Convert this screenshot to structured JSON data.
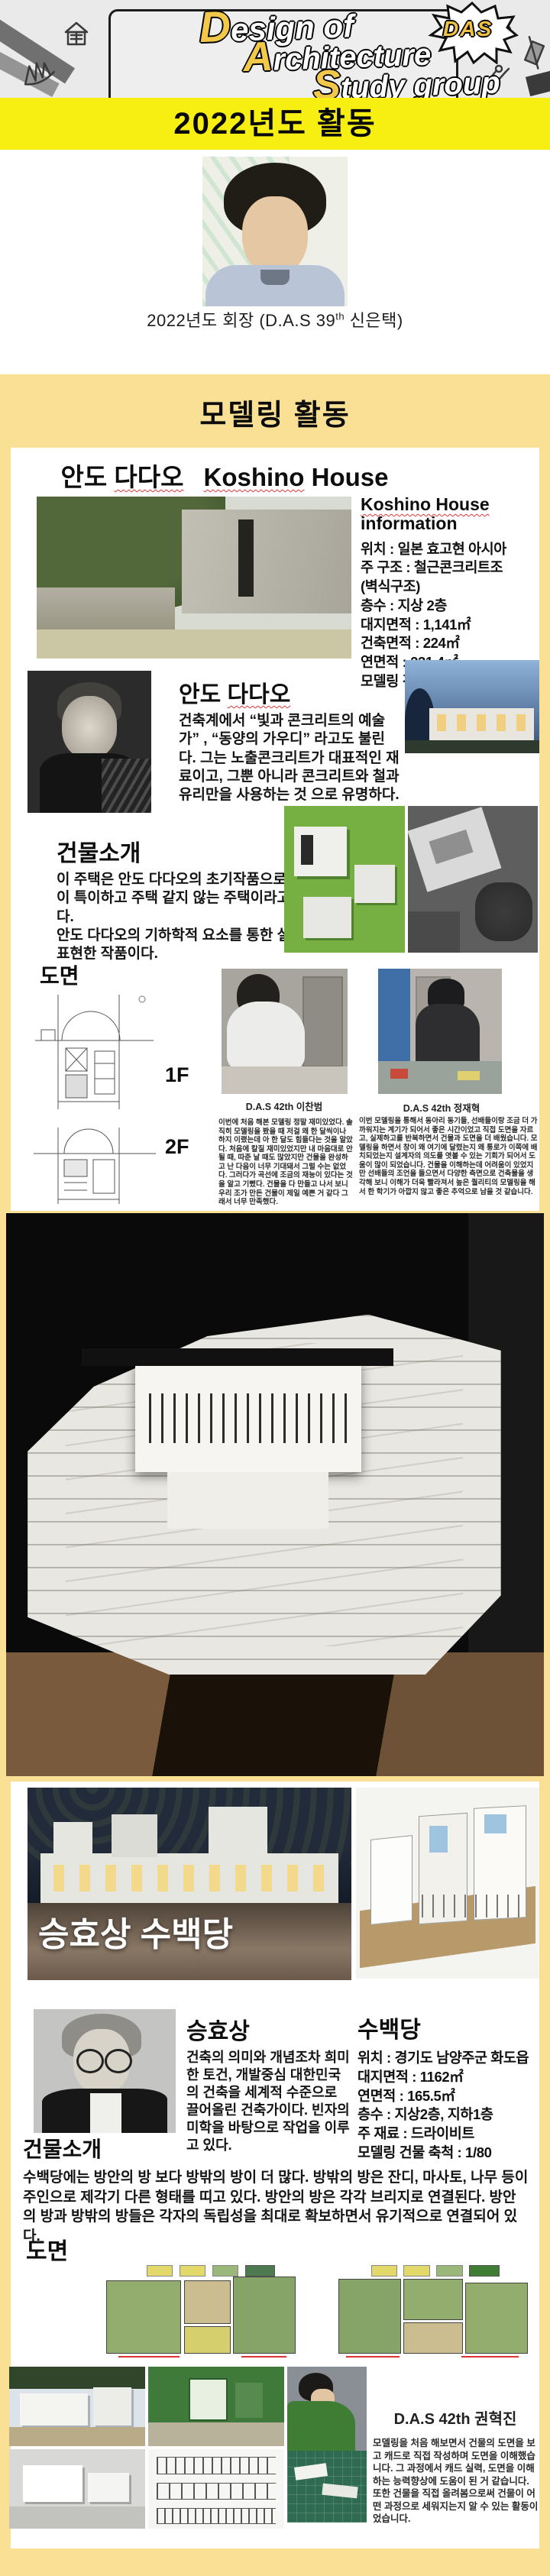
{
  "header": {
    "logo": {
      "l1_cap": "D",
      "l1_rest": "esign of",
      "l2_cap": "A",
      "l2_rest": "rchitecture",
      "l3_cap": "S",
      "l3_rest": "tudy group"
    },
    "badge": "DAS"
  },
  "banners": {
    "year": "2022년도 활동",
    "modeling": "모델링 활동"
  },
  "president": {
    "caption_pre": "2022년도 회장 (D.A.S 39",
    "caption_sup": "th",
    "caption_post": " 신은택)"
  },
  "koshino": {
    "title": {
      "kr1": "안도 ",
      "kr2": "다다오",
      "en1": "Koshino",
      "en2": " House"
    },
    "info": {
      "heading1": "Koshino House",
      "heading2": "information",
      "lines": [
        "위치 : 일본 효고현 아시아",
        "주 구조 : 철근콘크리트조",
        "(벽식구조)",
        "층수 : 지상 2층",
        "대지면적 : 1,141㎡",
        "건축면적 : 224㎡",
        "연면적 : 231.4㎡",
        "모델링 건물 축척 :1/75"
      ]
    },
    "architect": {
      "heading1": "안도 ",
      "heading2": "다다오",
      "body": "건축계에서 “빛과 콘크리트의 예술가” , “동양의 가우디” 라고도 불린다. 그는 노출콘크리트가 대표적인 재료이고, 그뿐 아니라 콘크리트와 철과 유리만을 사용하는 것 으로 유명하다."
    },
    "intro": {
      "heading": "건물소개",
      "body": "이 주택은 안도 다다오의 초기작품으로 공간구성이 특이하고 주택 같지 않는 주택이라고 느껴진다.\n안도 다다오의 기하학적 요소를 통한 설계를 잘 표현한 작품이다."
    },
    "plans": {
      "heading": "도면",
      "floor1": "1F",
      "floor2": "2F"
    },
    "members": [
      {
        "caption": "D.A.S 42th 이찬범",
        "body": "이번에 처음 해본 모델링 정말 재미있었다. 솔직히 모델링을 봤을 때 저걸 왜 한 달씩이나 하지 이랬는데 아 한 달도 힘들다는 것을 알았다. 처음에 칼질 재미있었지만 내 마음대로 안될 때, 따준 날 때도 많았지만 건물을 완성하고 난 다음이 너무 기대돼서 그럴 수는 없었다. 그러다가 곡선에 조금의 재능이 있다는 것을 알고 기뻤다. 건물을 다 만들고 나서 보니 우리 조가 만든 건물이 제일 예쁜 거 같다 그래서 너무 만족했다."
      },
      {
        "caption": "D.A.S 42th 정재혁",
        "body": "이번 모델링을 통해서 동아리 동기들, 선배들이랑 조금 더 가까워지는 계기가 되어서 좋은 시간이었고 직접 도면을 자르고, 실제하고를 반복하면서 건물과 도면을 더 배웠습니다. 모델링을 하면서 창이 왜 여기에 달렸는지 왜 통로가 이쪽에 배치되었는지 설계자의 의도를 엿볼 수 있는 기회가 되어서 도움이 많이 되었습니다. 건물을 이해하는데 어려움이 있었지만 선배들의 조언을 들으면서 다양한 측면으로 건축물을 생각해 보니 이해가 더욱 빨라져서 높은 퀄리티의 모델링을 해서 한 학기가 아깝지 않고 좋은 추억으로 남을 것 같습니다."
      }
    ]
  },
  "subaekdang": {
    "overlay_title": "승효상 수백당",
    "architect": {
      "heading": "승효상",
      "body": "건축의 의미와 개념조차 희미한 토건, 개발중심 대한민국의 건축을 세계적 수준으로 끌어올린 건축가이다. 빈자의 미학을 바탕으로 작업을 이루고 있다."
    },
    "building": {
      "heading": "수백당",
      "lines": [
        "위치 : 경기도 남양주군 화도읍",
        "대지면적 : 1162㎡",
        "연면적 : 165.5㎡",
        "층수 : 지상2층, 지하1층",
        "주 재료 : 드라이비트",
        "모델링 건물 축척 : 1/80"
      ]
    },
    "intro": {
      "heading": "건물소개",
      "body": "수백당에는 방안의 방 보다 방밖의 방이 더 많다. 방밖의 방은 잔디, 마사토, 나무 등이 주인으로 제각기 다른 형태를 띠고 있다. 방안의 방은 각각 브리지로 연결된다. 방안의 방과 방밖의 방들은 각자의 독립성을 최대로 확보하면서 유기적으로 연결되어 있다."
    },
    "plans_heading": "도면",
    "member": {
      "caption": "D.A.S 42th 권혁진",
      "body": "모델링을 처음 해보면서 건물의 도면을 보고 캐드로 직접 작성하며 도면을 이해했습니다. 그 과정에서 캐드 실력, 도면을 이해하는 능력향상에 도움이 된 거 같습니다. 또한 건물을 직접 올려봄으로써 건물이 어떤 과정으로 세워지는지 알 수 있는 활동이었습니다."
    }
  },
  "colors": {
    "banner_yellow": "#f8ef12",
    "page_yellow": "#f9e095",
    "accent_gold": "#f2c84b",
    "spellcheck_red": "#e03535"
  }
}
